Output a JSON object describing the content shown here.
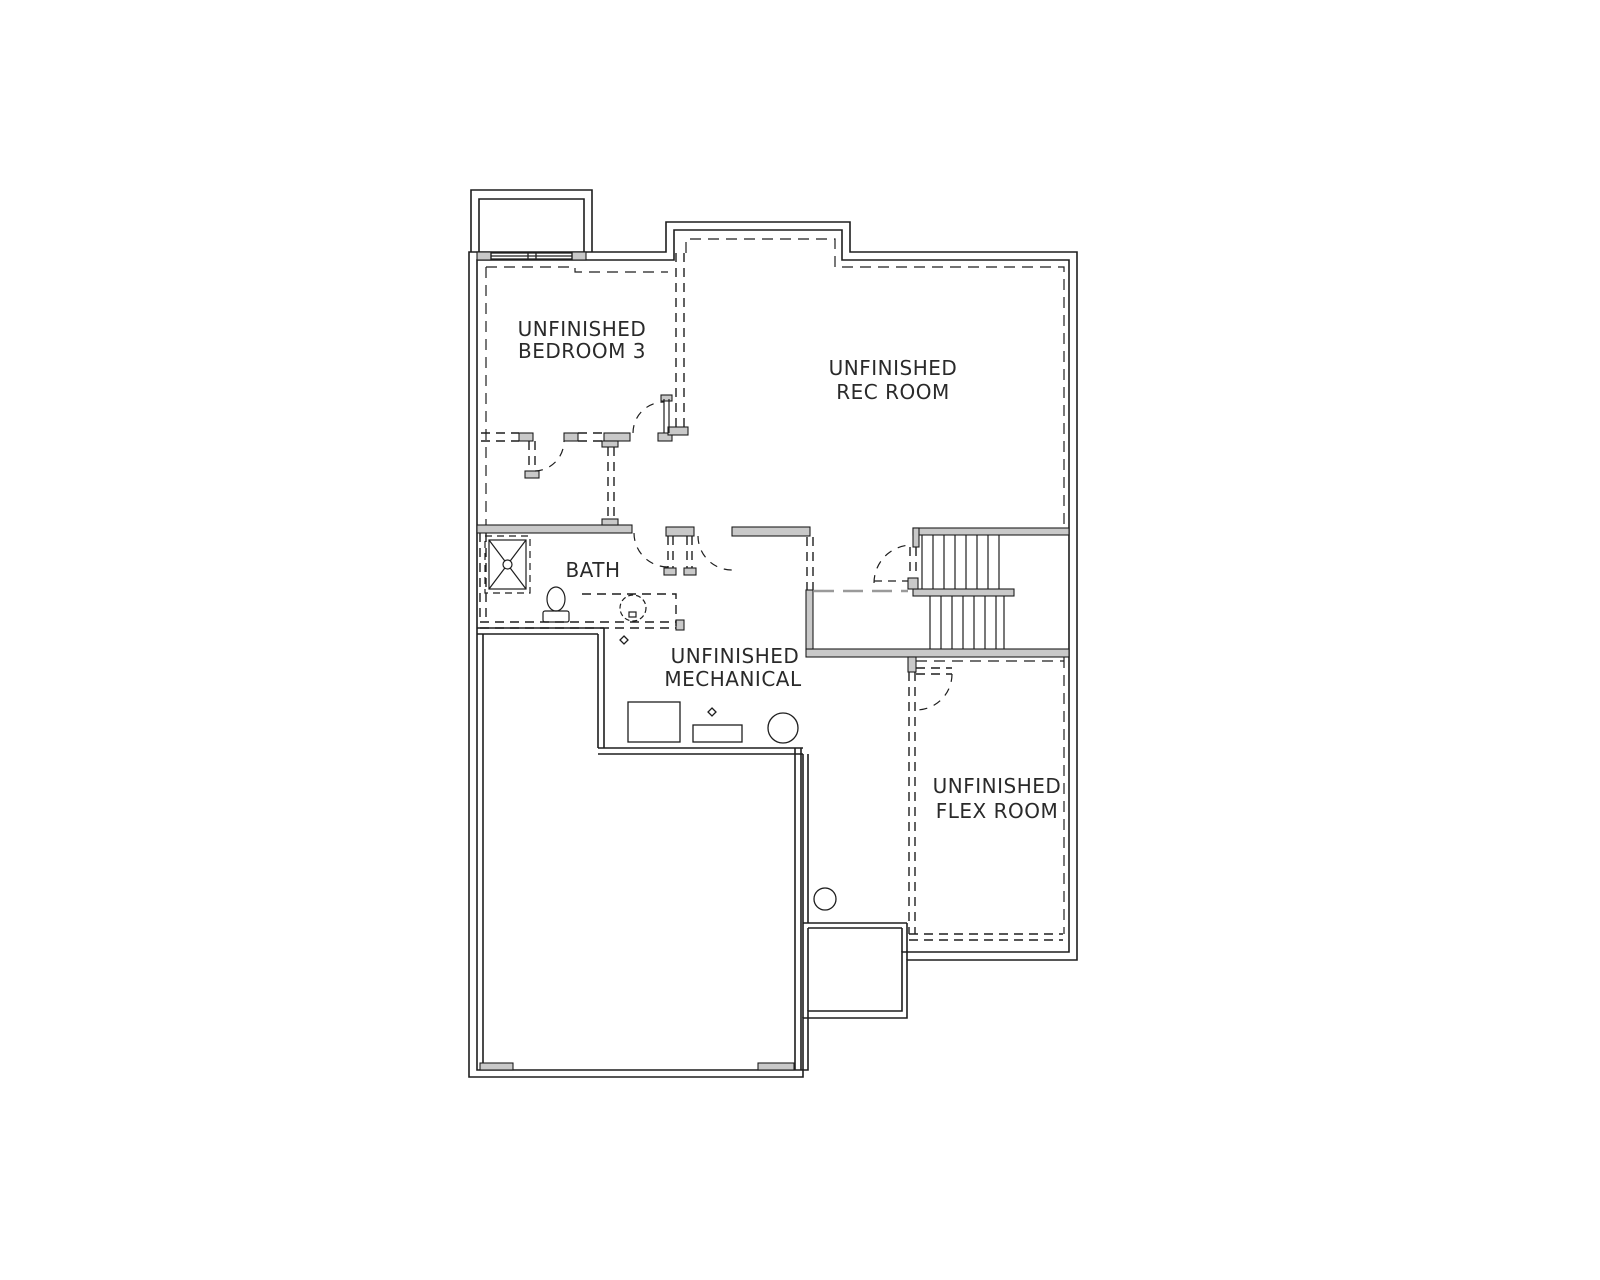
{
  "rooms": [
    {
      "id": "bedroom-3",
      "lines": [
        "UNFINISHED",
        "BEDROOM 3"
      ]
    },
    {
      "id": "rec-room",
      "lines": [
        "UNFINISHED",
        "REC ROOM"
      ]
    },
    {
      "id": "bath",
      "lines": [
        "BATH"
      ]
    },
    {
      "id": "mechanical",
      "lines": [
        "UNFINISHED",
        "MECHANICAL"
      ]
    },
    {
      "id": "flex-room",
      "lines": [
        "UNFINISHED",
        "FLEX ROOM"
      ]
    }
  ],
  "fixtures": [
    {
      "name": "shower"
    },
    {
      "name": "toilet"
    },
    {
      "name": "sink"
    },
    {
      "name": "furnace"
    },
    {
      "name": "hvac-unit"
    },
    {
      "name": "water-heater"
    },
    {
      "name": "sump-pump"
    },
    {
      "name": "floor-drain"
    },
    {
      "name": "window"
    },
    {
      "name": "stairs"
    },
    {
      "name": "window-well"
    }
  ],
  "colors": {
    "line": "#1e1e1e",
    "wall_fill": "#c9c9c9",
    "dash_gray": "#9a9a9a",
    "text": "#2a2a2a",
    "background": "#ffffff"
  }
}
